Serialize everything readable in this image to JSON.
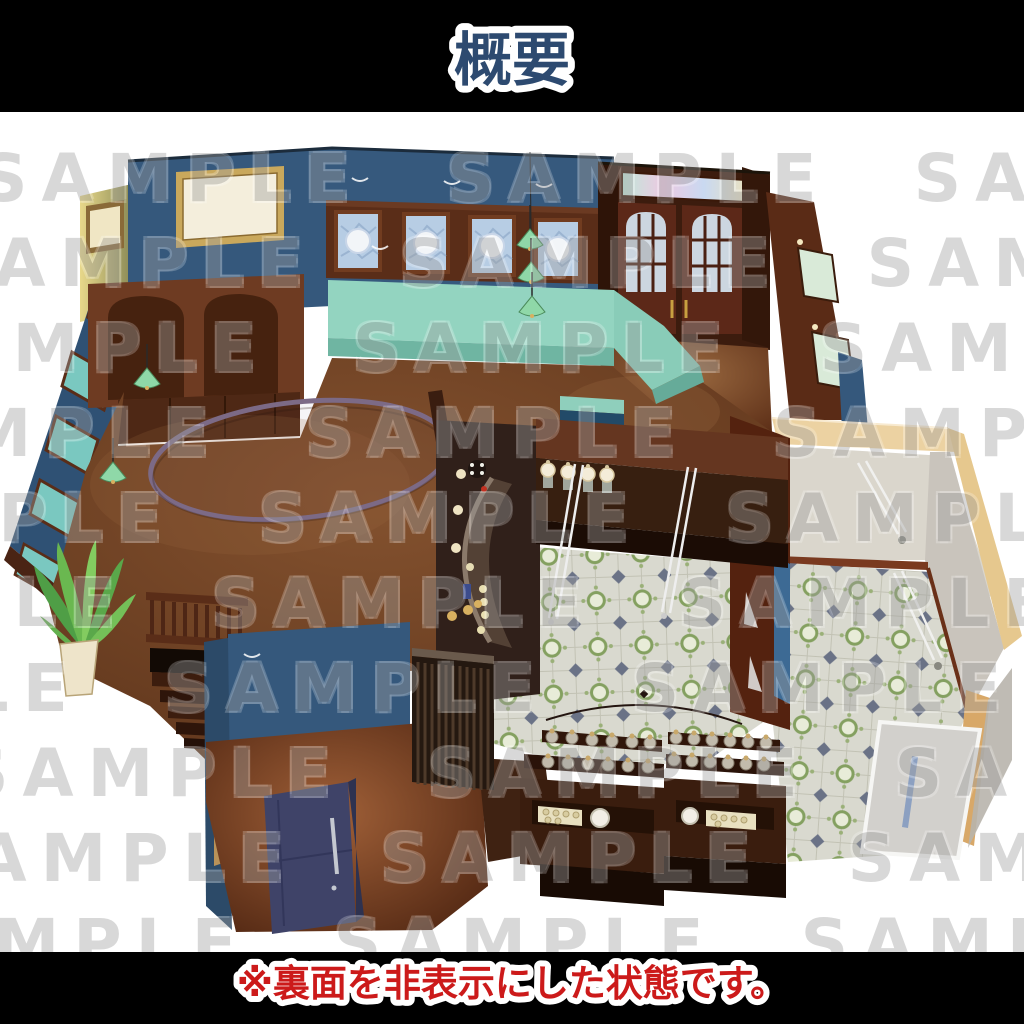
{
  "header": {
    "title": "概要"
  },
  "footer": {
    "caption": "※裏面を非表示にした状態です。"
  },
  "watermark": {
    "text": "SAMPLE",
    "rows": 10,
    "row_height": 85,
    "per_row": 4
  },
  "palette": {
    "background": "#000000",
    "canvas": "#ffffff",
    "title_fill": "#2d4a70",
    "caption_fill": "#cc1a1a",
    "watermark": "#9f9f9f",
    "wall_blue": "#35587c",
    "wall_blue_dark": "#2c4a68",
    "wood_dark": "#4a2414",
    "wood_mid": "#6e3b22",
    "floor_brown": "#7a4a2c",
    "bench_teal": "#93d4c0",
    "tile_base": "#d9d9cf",
    "tile_green": "#84a060",
    "wall_tan": "#ecd2a2",
    "door_navy": "#3f4368",
    "lamp_green": "#8fd8a8",
    "glass_blue": "#b7cde4"
  }
}
